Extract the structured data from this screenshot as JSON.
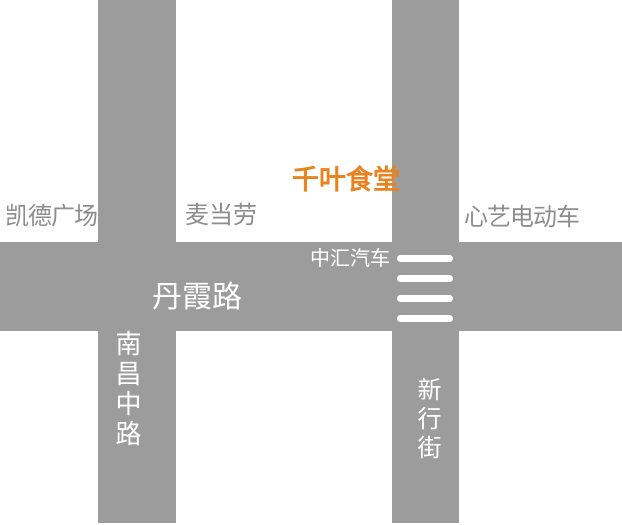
{
  "map": {
    "colors": {
      "background": "#ffffff",
      "road": "#9c9c9c",
      "place_label": "#8d8d8d",
      "road_label": "#ffffff",
      "highlight": "#e8831f",
      "crosswalk": "#ffffff"
    },
    "roads": {
      "danxia": {
        "label": "丹霞路",
        "orientation": "horizontal"
      },
      "nanchang": {
        "label": "南昌中路",
        "orientation": "vertical"
      },
      "xinxing": {
        "label": "新行街",
        "orientation": "vertical"
      }
    },
    "places": {
      "kaide_plaza": {
        "label": "凯德广场"
      },
      "mcdonalds": {
        "label": "麦当劳"
      },
      "qianye_canteen": {
        "label": "千叶食堂",
        "highlighted": true
      },
      "xinyi_ebike": {
        "label": "心艺电动车"
      },
      "zhonghui_auto": {
        "label": "中汇汽车"
      }
    },
    "crosswalk": {
      "dashes": 4
    }
  }
}
